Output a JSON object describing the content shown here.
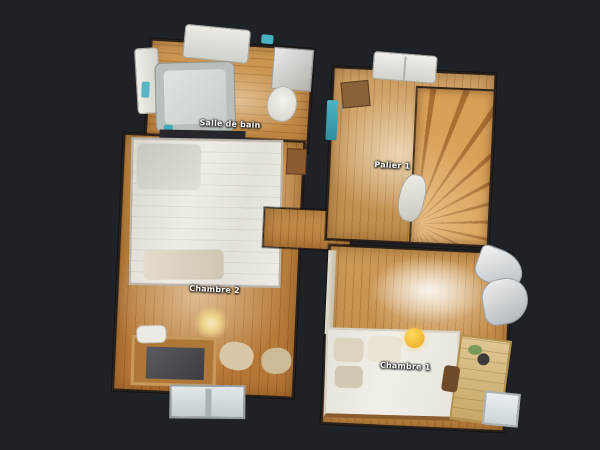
{
  "scene": {
    "view": "dollhouse-top-floorplan",
    "background_color": "#1e2126",
    "rooms": [
      {
        "id": "salle-de-bain",
        "label": "Salle de bain"
      },
      {
        "id": "palier-1",
        "label": "Palier 1"
      },
      {
        "id": "chambre-2",
        "label": "Chambre 2"
      },
      {
        "id": "chambre-1",
        "label": "Chambre 1"
      }
    ],
    "colors": {
      "wood_floor": "#c08a45",
      "wood_light": "#d2a468",
      "stairs": "#cd8c48",
      "bed_white": "#eceae3",
      "bathtub_gray": "#c6ccc6",
      "accent_teal": "#3fa9bb",
      "lamp_glow": "#f5d878",
      "ball_yellow": "#f3b63a",
      "label_text": "#ffffff"
    }
  }
}
